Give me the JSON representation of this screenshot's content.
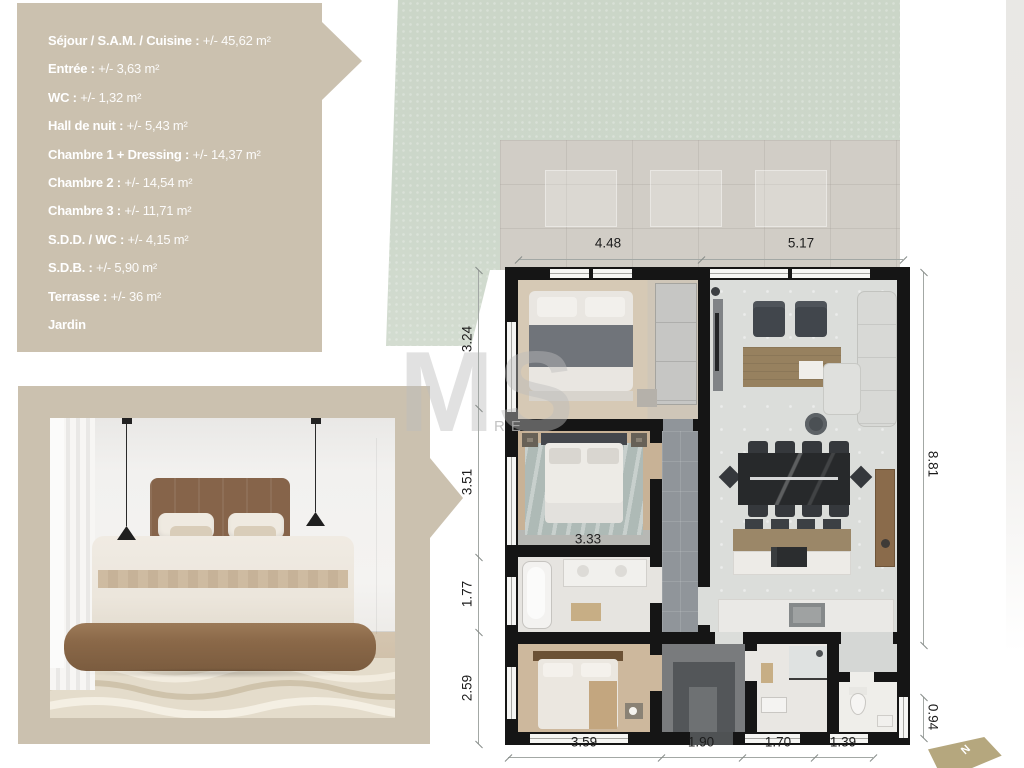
{
  "legend": {
    "items": [
      {
        "label": "Séjour / S.A.M. / Cuisine",
        "value": "+/- 45,62 m²"
      },
      {
        "label": "Entrée",
        "value": "+/- 3,63 m²"
      },
      {
        "label": "WC",
        "value": "+/- 1,32 m²"
      },
      {
        "label": "Hall de nuit",
        "value": "+/- 5,43 m²"
      },
      {
        "label": "Chambre 1 + Dressing",
        "value": "+/- 14,37 m²"
      },
      {
        "label": "Chambre 2",
        "value": "+/- 14,54 m²"
      },
      {
        "label": "Chambre 3",
        "value": "+/- 11,71 m²"
      },
      {
        "label": "S.D.D. / WC",
        "value": "+/- 4,15 m²"
      },
      {
        "label": "S.D.B.",
        "value": "+/- 5,90 m²"
      },
      {
        "label": "Terrasse",
        "value": "+/- 36 m²"
      },
      {
        "label": "Jardin",
        "value": ""
      }
    ]
  },
  "plan": {
    "dimensions": {
      "top": [
        "4.48",
        "5.17"
      ],
      "left": [
        "3.24",
        "3.51",
        "1.77",
        "2.59"
      ],
      "right": [
        "8.81",
        "0.94"
      ],
      "bottom": [
        "3.59",
        "1.90",
        "1.70",
        "1.39"
      ],
      "interior": [
        "3.33"
      ]
    }
  },
  "compass": {
    "north_label": "N"
  },
  "watermark": {
    "large": "MS",
    "small": "RE"
  },
  "colors": {
    "legend_bg": "#cbc1af",
    "garden": "#ccd7ca",
    "terrace": "#d1cdc6",
    "wall": "#151515",
    "accent_gold": "#b5a77e"
  }
}
